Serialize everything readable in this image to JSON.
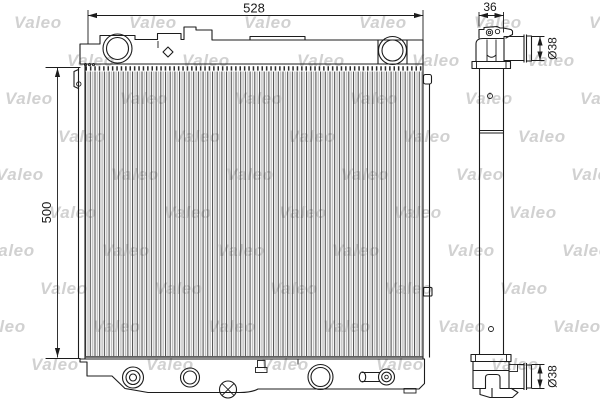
{
  "diagram": {
    "watermark_text": "Valeo",
    "dimensions": {
      "overall_width": "528",
      "core_height": "500",
      "tank_depth": "36",
      "top_pipe_diameter": "Ø38",
      "bottom_pipe_diameter": "Ø38"
    },
    "colors": {
      "background": "#ffffff",
      "line": "#1c1c1c",
      "watermark": "#c6c6c6"
    }
  }
}
